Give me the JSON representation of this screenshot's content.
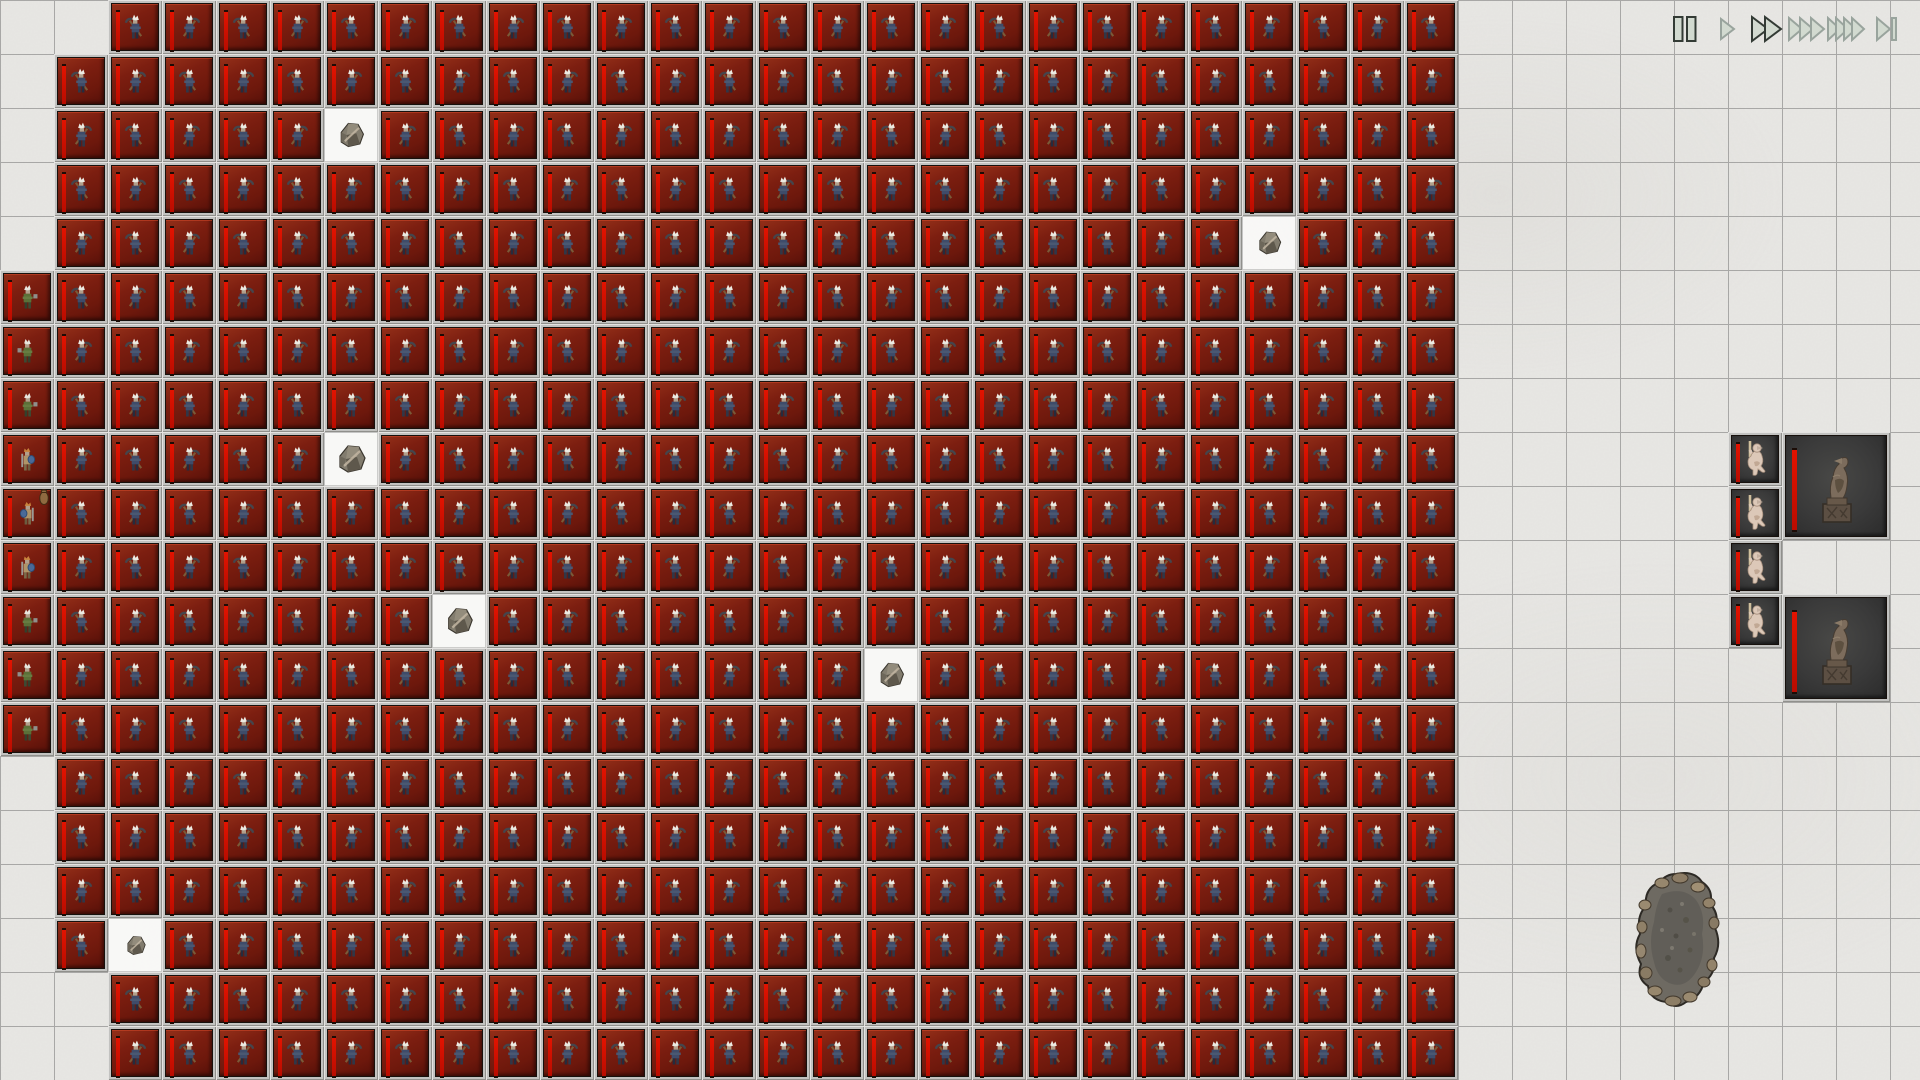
{
  "scene": {
    "kind": "tile-battle-simulation",
    "board_name": "snow-battlefield"
  },
  "grid": {
    "tile_size": 54,
    "cols": 36,
    "rows": 20
  },
  "colors": {
    "snow_base": "#e8e7e4",
    "grid_line": "#6b6b6b",
    "tile_frame": "#c2c2c0",
    "red_field": "#7c1e10",
    "dark_field": "#3a3a3a",
    "health_bar": "#e31300",
    "icon_dark_stroke": "#333b35",
    "icon_light_stroke": "#99a49d",
    "icon_fill": "#d2dad0"
  },
  "army": {
    "default_unit": "scythe-militia",
    "rows": [
      {
        "row": 0,
        "start_col": 2,
        "end_col": 26
      },
      {
        "row": 1,
        "start_col": 1,
        "end_col": 26
      },
      {
        "row": 2,
        "start_col": 1,
        "end_col": 26
      },
      {
        "row": 3,
        "start_col": 1,
        "end_col": 26
      },
      {
        "row": 4,
        "start_col": 1,
        "end_col": 26
      },
      {
        "row": 5,
        "start_col": 0,
        "end_col": 26
      },
      {
        "row": 6,
        "start_col": 0,
        "end_col": 26
      },
      {
        "row": 7,
        "start_col": 0,
        "end_col": 26
      },
      {
        "row": 8,
        "start_col": 0,
        "end_col": 26
      },
      {
        "row": 9,
        "start_col": 0,
        "end_col": 26
      },
      {
        "row": 10,
        "start_col": 0,
        "end_col": 26
      },
      {
        "row": 11,
        "start_col": 0,
        "end_col": 26
      },
      {
        "row": 12,
        "start_col": 0,
        "end_col": 26
      },
      {
        "row": 13,
        "start_col": 0,
        "end_col": 26
      },
      {
        "row": 14,
        "start_col": 1,
        "end_col": 26
      },
      {
        "row": 15,
        "start_col": 1,
        "end_col": 26
      },
      {
        "row": 16,
        "start_col": 1,
        "end_col": 26
      },
      {
        "row": 17,
        "start_col": 1,
        "end_col": 26
      },
      {
        "row": 18,
        "start_col": 2,
        "end_col": 26
      },
      {
        "row": 19,
        "start_col": 2,
        "end_col": 26
      }
    ],
    "gaps": [
      {
        "row": 2,
        "col": 6
      },
      {
        "row": 4,
        "col": 23
      },
      {
        "row": 8,
        "col": 6
      },
      {
        "row": 11,
        "col": 8
      },
      {
        "row": 12,
        "col": 16
      },
      {
        "row": 17,
        "col": 2
      }
    ],
    "left_column_special": [
      {
        "row": 5,
        "unit": "green-axeman"
      },
      {
        "row": 6,
        "unit": "green-axeman"
      },
      {
        "row": 7,
        "unit": "green-axeman"
      },
      {
        "row": 8,
        "unit": "shield-swordsman"
      },
      {
        "row": 9,
        "unit": "shield-swordsman"
      },
      {
        "row": 10,
        "unit": "shield-swordsman"
      },
      {
        "row": 11,
        "unit": "green-axeman"
      },
      {
        "row": 12,
        "unit": "green-axeman"
      },
      {
        "row": 13,
        "unit": "green-axeman"
      }
    ],
    "pouch_overlay": {
      "row": 9,
      "col": 0
    }
  },
  "rocks": [
    {
      "row": 2,
      "col": 6,
      "size": 32
    },
    {
      "row": 4,
      "col": 23,
      "size": 30
    },
    {
      "row": 8,
      "col": 6,
      "size": 36
    },
    {
      "row": 11,
      "col": 8,
      "size": 34
    },
    {
      "row": 12,
      "col": 16,
      "size": 32
    },
    {
      "row": 17,
      "col": 2,
      "size": 25
    }
  ],
  "boulder": {
    "x": 1632,
    "y": 870,
    "width": 92,
    "height": 142
  },
  "right_panel": {
    "small_units": [
      {
        "row": 8,
        "col": 32,
        "unit": "pale-swordsman"
      },
      {
        "row": 9,
        "col": 32,
        "unit": "pale-swordsman"
      },
      {
        "row": 10,
        "col": 32,
        "unit": "pale-swordsman"
      },
      {
        "row": 11,
        "col": 32,
        "unit": "pale-swordsman"
      }
    ],
    "large_units": [
      {
        "row": 8,
        "col": 33,
        "span": 2,
        "unit": "statue"
      },
      {
        "row": 11,
        "col": 33,
        "span": 2,
        "unit": "statue"
      }
    ]
  },
  "playback": {
    "center_y": 30,
    "buttons": [
      {
        "name": "pause",
        "icon": "pause-icon",
        "center_x": 1685,
        "emphasized": true
      },
      {
        "name": "play",
        "icon": "play-icon",
        "center_x": 1728,
        "emphasized": false
      },
      {
        "name": "fast-forward",
        "icon": "fast-forward-2-icon",
        "center_x": 1767,
        "emphasized": true
      },
      {
        "name": "faster",
        "icon": "fast-forward-3-icon",
        "center_x": 1807,
        "emphasized": false
      },
      {
        "name": "fastest",
        "icon": "fast-forward-4-icon",
        "center_x": 1848,
        "emphasized": false
      },
      {
        "name": "skip-to-end",
        "icon": "skip-to-end-icon",
        "center_x": 1887,
        "emphasized": false
      }
    ]
  }
}
